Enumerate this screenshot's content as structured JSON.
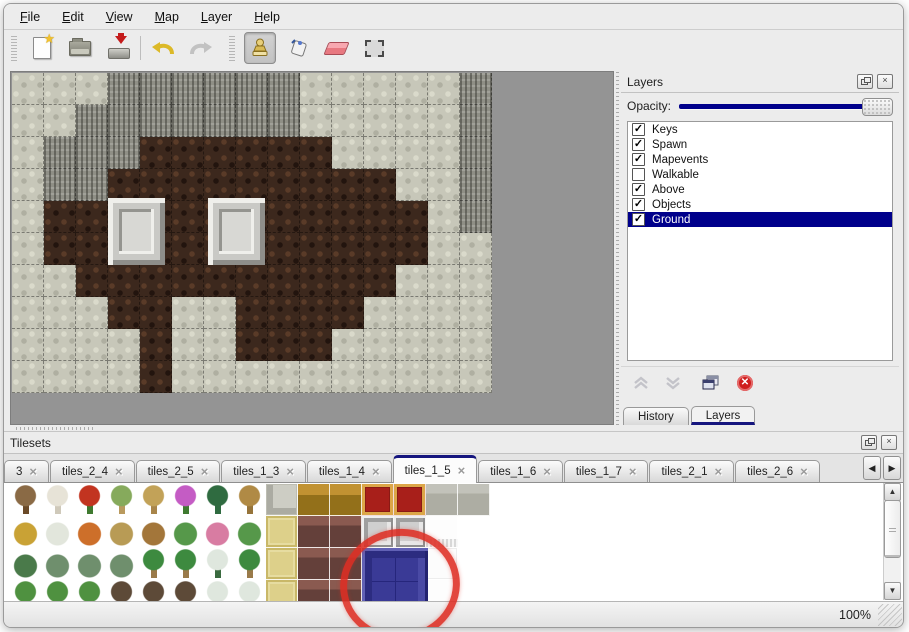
{
  "menu": {
    "items": [
      "File",
      "Edit",
      "View",
      "Map",
      "Layer",
      "Help"
    ]
  },
  "toolbar": {
    "buttons": [
      {
        "icon": "new-file-icon"
      },
      {
        "icon": "open-folder-icon"
      },
      {
        "icon": "save-icon"
      },
      {
        "icon": "undo-icon"
      },
      {
        "icon": "redo-icon"
      },
      {
        "icon": "stamp-tool-icon",
        "selected": true
      },
      {
        "icon": "fill-bucket-icon"
      },
      {
        "icon": "eraser-icon"
      },
      {
        "icon": "select-rect-icon"
      }
    ]
  },
  "layers_panel": {
    "title": "Layers",
    "opacity_label": "Opacity:",
    "opacity_percent": 100,
    "layers": [
      {
        "label": "Keys",
        "checked": true,
        "selected": false
      },
      {
        "label": "Spawn",
        "checked": true,
        "selected": false
      },
      {
        "label": "Mapevents",
        "checked": true,
        "selected": false
      },
      {
        "label": "Walkable",
        "checked": false,
        "selected": false
      },
      {
        "label": "Above",
        "checked": true,
        "selected": false
      },
      {
        "label": "Objects",
        "checked": true,
        "selected": false
      },
      {
        "label": "Ground",
        "checked": true,
        "selected": true
      }
    ],
    "footer_buttons": [
      "move-up",
      "move-down",
      "duplicate",
      "delete"
    ],
    "tabs": [
      {
        "label": "History",
        "active": false
      },
      {
        "label": "Layers",
        "active": true
      }
    ]
  },
  "tilesets_panel": {
    "title": "Tilesets",
    "tabs": [
      {
        "label": "3",
        "active": false
      },
      {
        "label": "tiles_2_4",
        "active": false
      },
      {
        "label": "tiles_2_5",
        "active": false
      },
      {
        "label": "tiles_1_3",
        "active": false
      },
      {
        "label": "tiles_1_4",
        "active": false
      },
      {
        "label": "tiles_1_5",
        "active": true
      },
      {
        "label": "tiles_1_6",
        "active": false
      },
      {
        "label": "tiles_1_7",
        "active": false
      },
      {
        "label": "tiles_2_1",
        "active": false
      },
      {
        "label": "tiles_2_6",
        "active": false
      }
    ],
    "close_glyph": "×",
    "scroll_left_glyph": "◀",
    "scroll_right_glyph": "▶"
  },
  "map": {
    "tile_size": 32,
    "legend": {
      "R": "light-rock",
      "C": "dark-cliff",
      "F": "brown-floor"
    },
    "grid": [
      "RRRCCCCCCRRRRRC",
      "RRCCCCCCCRRRRRC",
      "RCCCFFFFFFRRRRC",
      "RCCFFFFFFFFFRRC",
      "RFFFFFFFFFFFFRC",
      "RFFFFFFFFFFFFRR",
      "RRFFFFFFFFFFRRR",
      "RRRFFRRFFFFRRRR",
      "RRRRFRRFFFRRRRR",
      "RRRRFRRRRRRRRRR"
    ],
    "pedestals": [
      {
        "x": 97,
        "y": 126
      },
      {
        "x": 197,
        "y": 126
      }
    ]
  },
  "palette": {
    "rows": [
      [
        "deadtree",
        "whitebranch",
        "redflower",
        "stump",
        "trunk",
        "purpleflower",
        "fern",
        "brownplant",
        "stonepave",
        "woodgold",
        "woodgold",
        "carpet",
        "carpet",
        "stonegray",
        "stonegray"
      ],
      [
        "hay",
        "snowmound",
        "orangeflower",
        "drygrass",
        "leaves",
        "lilypad",
        "pinkflower",
        "lilypad",
        "mattan",
        "woodmaroon",
        "woodmaroon",
        "silver",
        "silver",
        "whitefringe",
        "empty"
      ],
      [
        "sprigs",
        "bush",
        "bush",
        "bush",
        "palm",
        "palm",
        "snowpine",
        "palm",
        "mattan",
        "woodmaroon",
        "woodmaroon",
        "empty",
        "empty",
        "whitetall",
        "empty"
      ],
      [
        "conetree",
        "conetree",
        "conetree",
        "deadtree2",
        "deadtree2",
        "deadtree2",
        "snowpine",
        "snowpine",
        "mattan",
        "woodmaroon",
        "woodmaroon",
        "empty",
        "empty",
        "whitefringe",
        "empty"
      ]
    ],
    "selected_tile": {
      "name": "blue-block",
      "color": "#3a3a96"
    }
  },
  "annotation": {
    "shape": "red-ellipse",
    "color": "#de2d23",
    "target": "selected-blue-tile"
  },
  "statusbar": {
    "zoom": "100%"
  },
  "colors": {
    "accent_navy": "#00008b",
    "tab_accent": "#15157e",
    "panel_bg": "#ececec",
    "canvas_bg": "#949494"
  }
}
